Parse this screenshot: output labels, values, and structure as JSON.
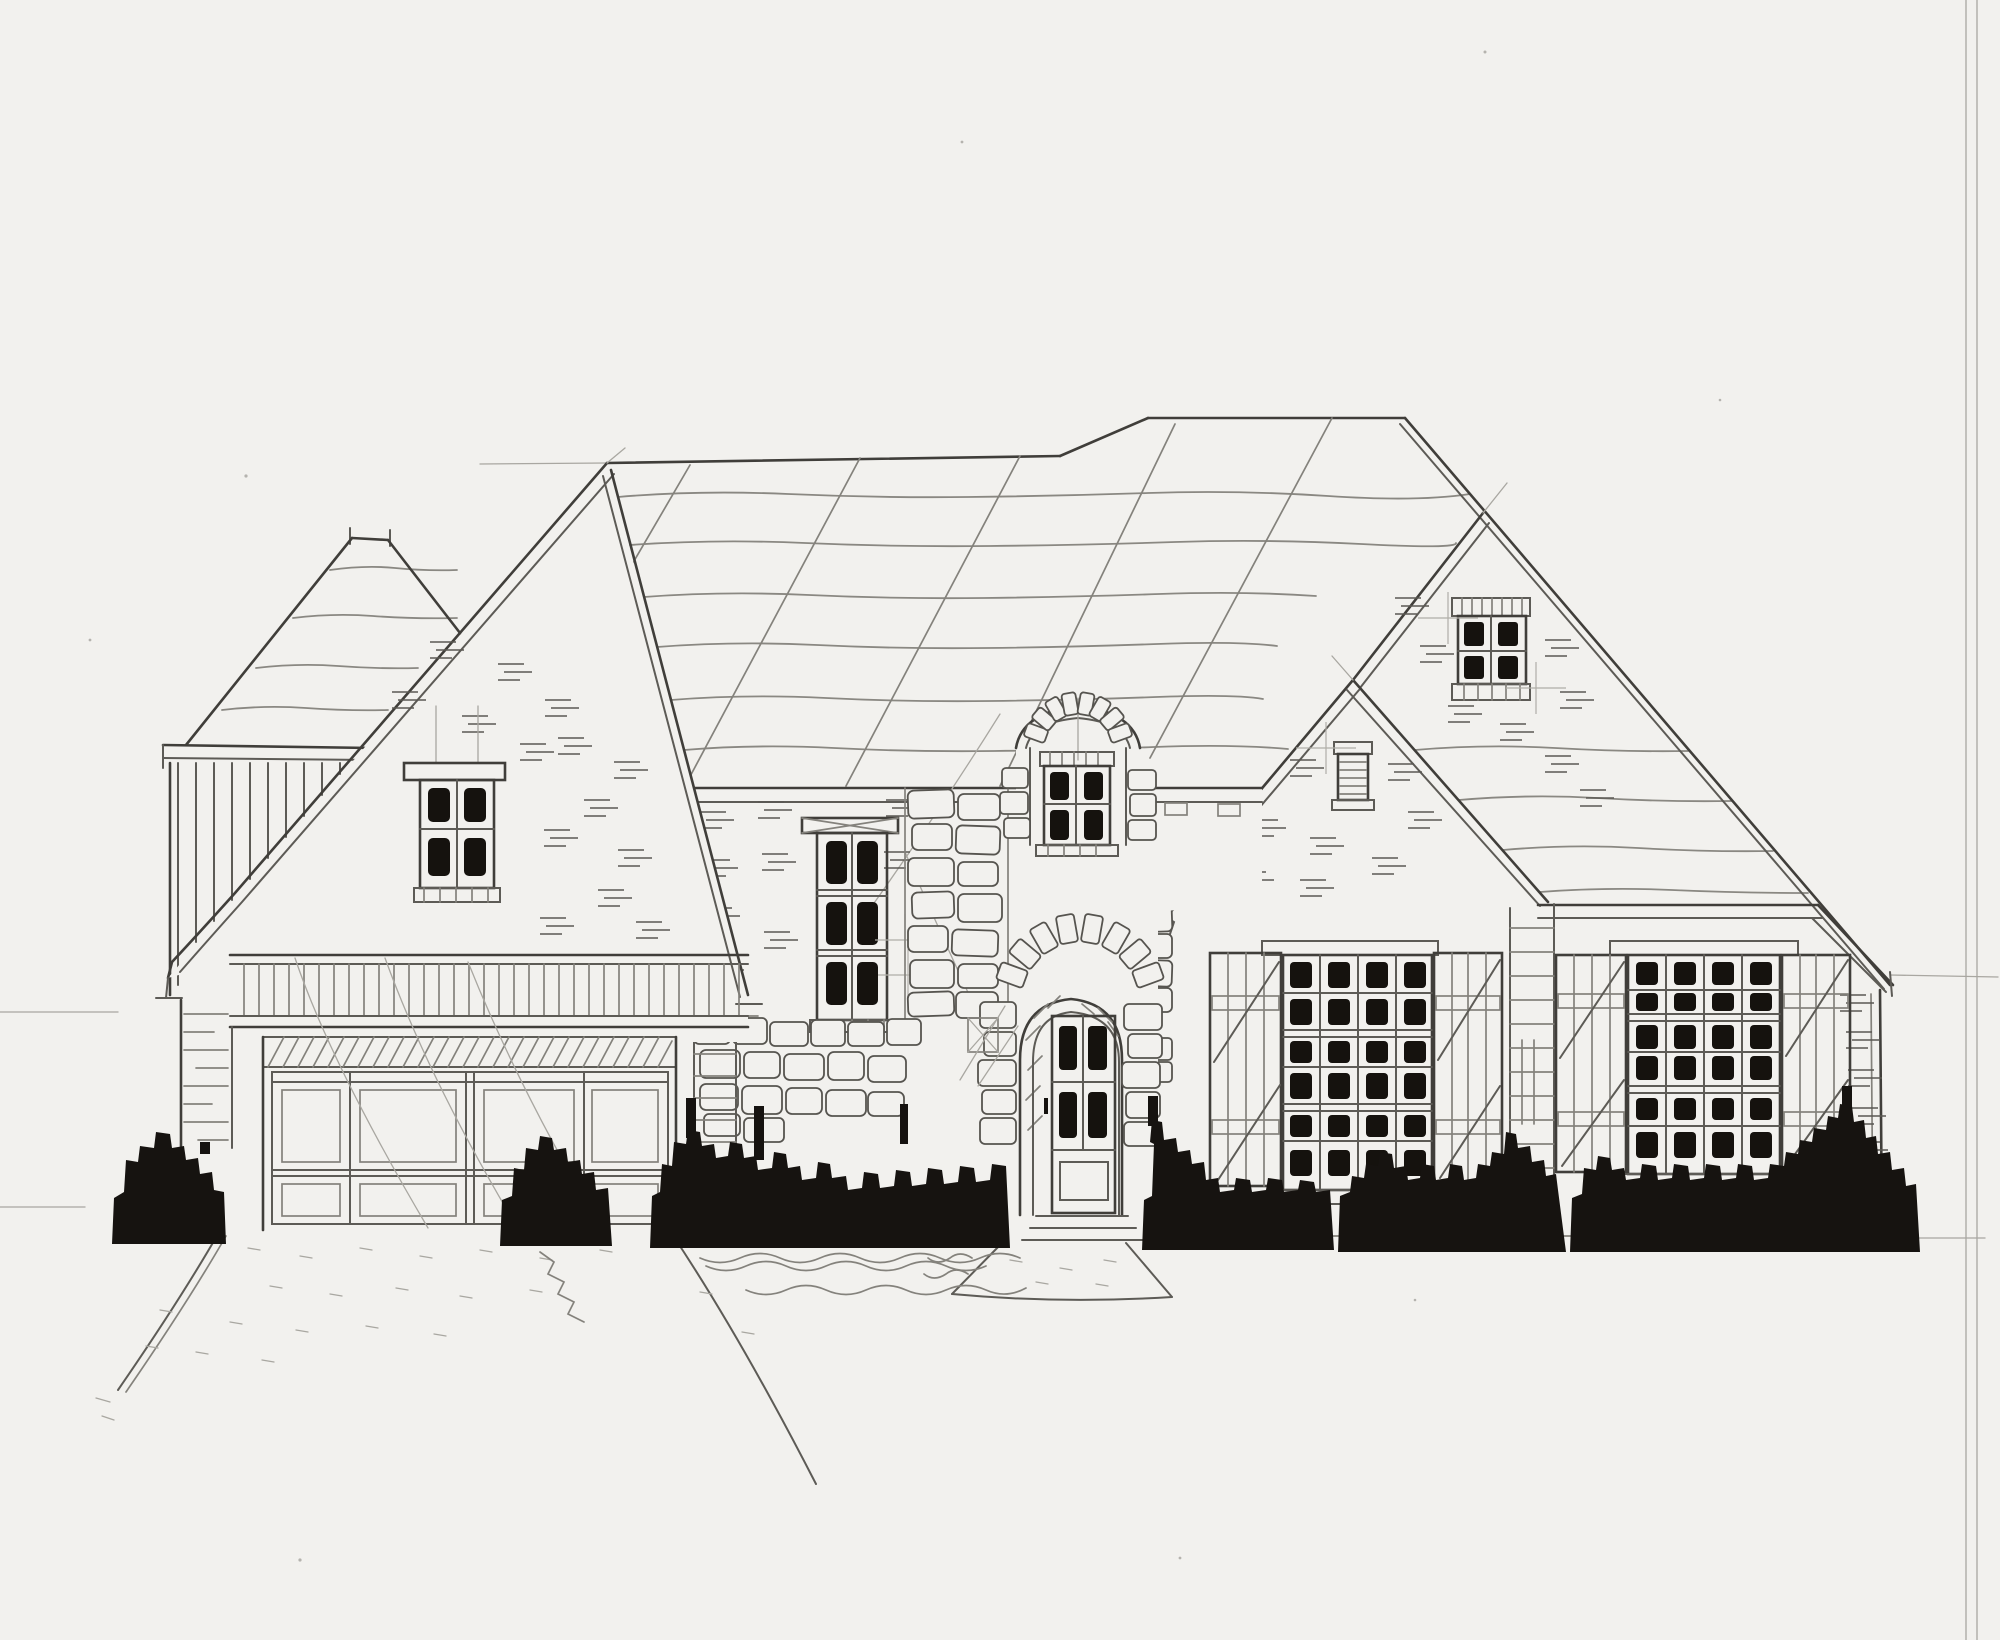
{
  "title": "Hand-drawn architectural front elevation sketch of a stone and brick cottage-style house",
  "caption": "Pencil and ink elevation drawing: hipped tower, catslide gable over a two-car garage, tall triple window, arched stone dormer over an arched entry door, twin right gables and two large shuttered multi-pane windows, with solid black ink shrubs and a flared driveway below.",
  "drawing": {
    "type": "architectural front elevation sketch",
    "medium": "pencil and ink on paper",
    "palette": {
      "paper": "#f2f1ee",
      "pencil_dark": "#403e3a",
      "pencil_mid": "#5d5b56",
      "pencil_light": "#a9a7a1",
      "ink_black": "#161310"
    },
    "sections": {
      "left_tower": "small hip-roofed tower with vertical board siding and brick pier",
      "left_gable": "steep catslide gable with 4-pane window above trellis band and garage",
      "garage": "two-car garage door with hatched lintel, 4-panel grid doors",
      "center": "tall 6-pane window, stone chimney strip, arched stone dormer window above arched entry door with stone surround",
      "right_gables": "rear gable with 4-pane attic window, front gable with louvered vent",
      "right_wing": "two large 24-pane windows flanked by board-and-batten shutters, stone column between"
    },
    "windows": [
      {
        "name": "left-gable-window",
        "panes": 4
      },
      {
        "name": "tall-center-window",
        "panes": 6
      },
      {
        "name": "dormer-window",
        "panes": 4
      },
      {
        "name": "attic-gable-window",
        "panes": 4
      },
      {
        "name": "gable-louver-vent",
        "panes": 0
      },
      {
        "name": "right-window-1",
        "panes": 24,
        "shutters": 2
      },
      {
        "name": "right-window-2",
        "panes": 24,
        "shutters": 2
      }
    ],
    "door": {
      "name": "entry-door",
      "glass_panes": 4,
      "arched_stone_surround": true,
      "steps": 3
    },
    "landscaping": "continuous black ink shrub hedge across the foundation, flared driveway at left, stone walkway at entry"
  }
}
